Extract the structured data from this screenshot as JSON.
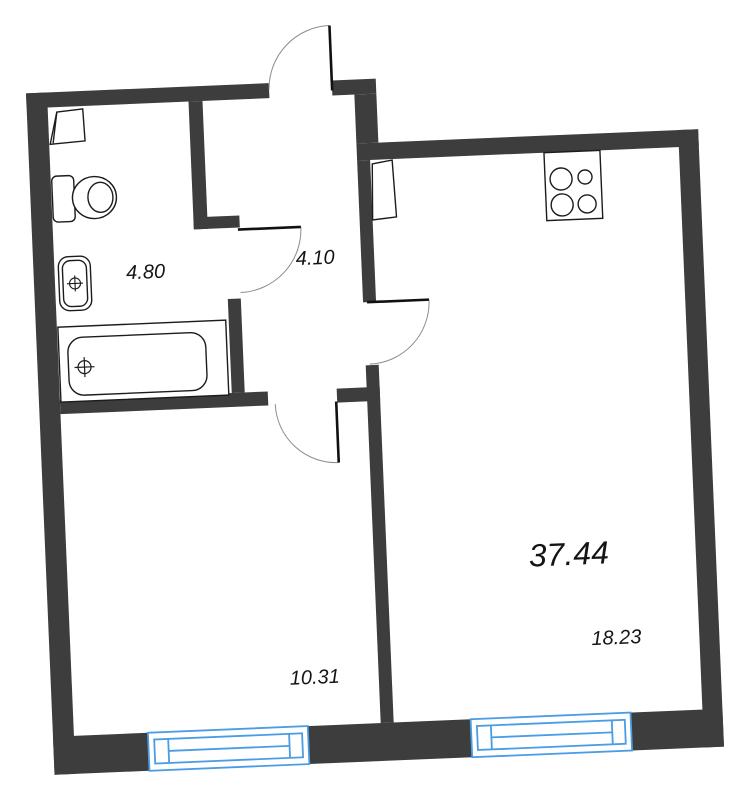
{
  "plan": {
    "type": "apartment-floor-plan",
    "total_area": "37.44",
    "rooms": [
      {
        "name": "bathroom",
        "area": "4.80"
      },
      {
        "name": "hallway",
        "area": "4.10"
      },
      {
        "name": "bedroom",
        "area": "10.31"
      },
      {
        "name": "living-kitchen",
        "area": "18.23"
      }
    ],
    "doors": [
      "entrance-door",
      "bathroom-door",
      "living-room-door",
      "bedroom-door"
    ],
    "windows": [
      "bedroom-window",
      "living-room-window"
    ],
    "fixtures": [
      "corner-shelf",
      "toilet",
      "sink",
      "bathtub",
      "stove",
      "ventilation-shaft"
    ],
    "colors": {
      "wall": "#3d3d3d",
      "window": "#4a9de4",
      "fixture_outline": "#1c1c1c",
      "door_arc": "#8c8c8c",
      "door_leaf": "#111111",
      "label_text": "#141414",
      "background": "#ffffff"
    }
  }
}
